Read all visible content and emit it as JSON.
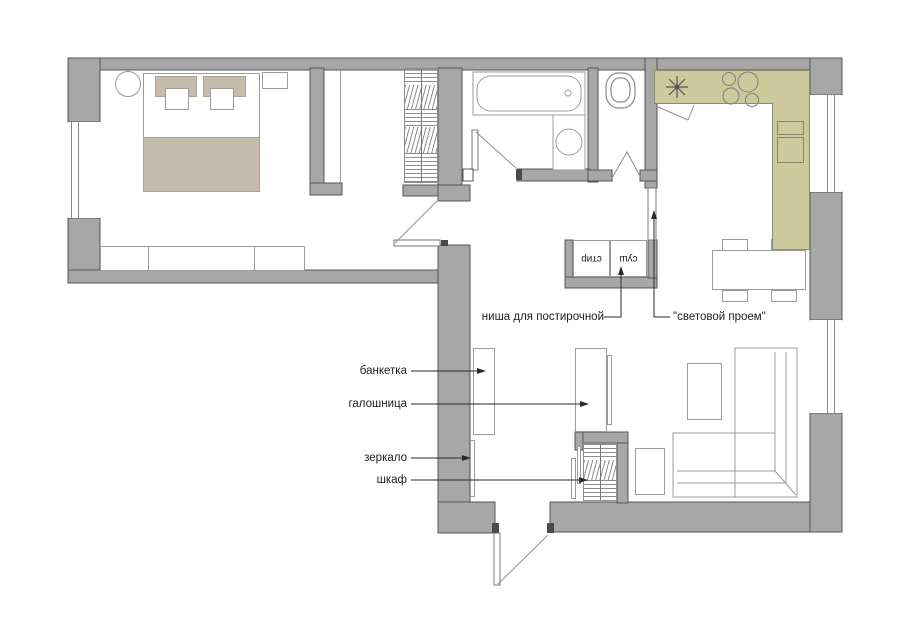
{
  "floor_plan": {
    "labels": {
      "laundry_niche": "ниша для постирочной",
      "light_opening": "\"световой проем\"",
      "bench": "банкетка",
      "shoe_cabinet": "галошница",
      "mirror": "зеркало",
      "wardrobe": "шкаф",
      "washer": "стир",
      "dryer": "суш"
    },
    "colors": {
      "wall_fill": "#a7a7a7",
      "wall_outline": "#56565a",
      "kitchen_counter": "#cdc99c",
      "counter_outline": "#8f8b6e",
      "textile": "#c6bcab",
      "furniture_line": "#9b9b9b",
      "label_text": "#1c1c1c"
    }
  }
}
